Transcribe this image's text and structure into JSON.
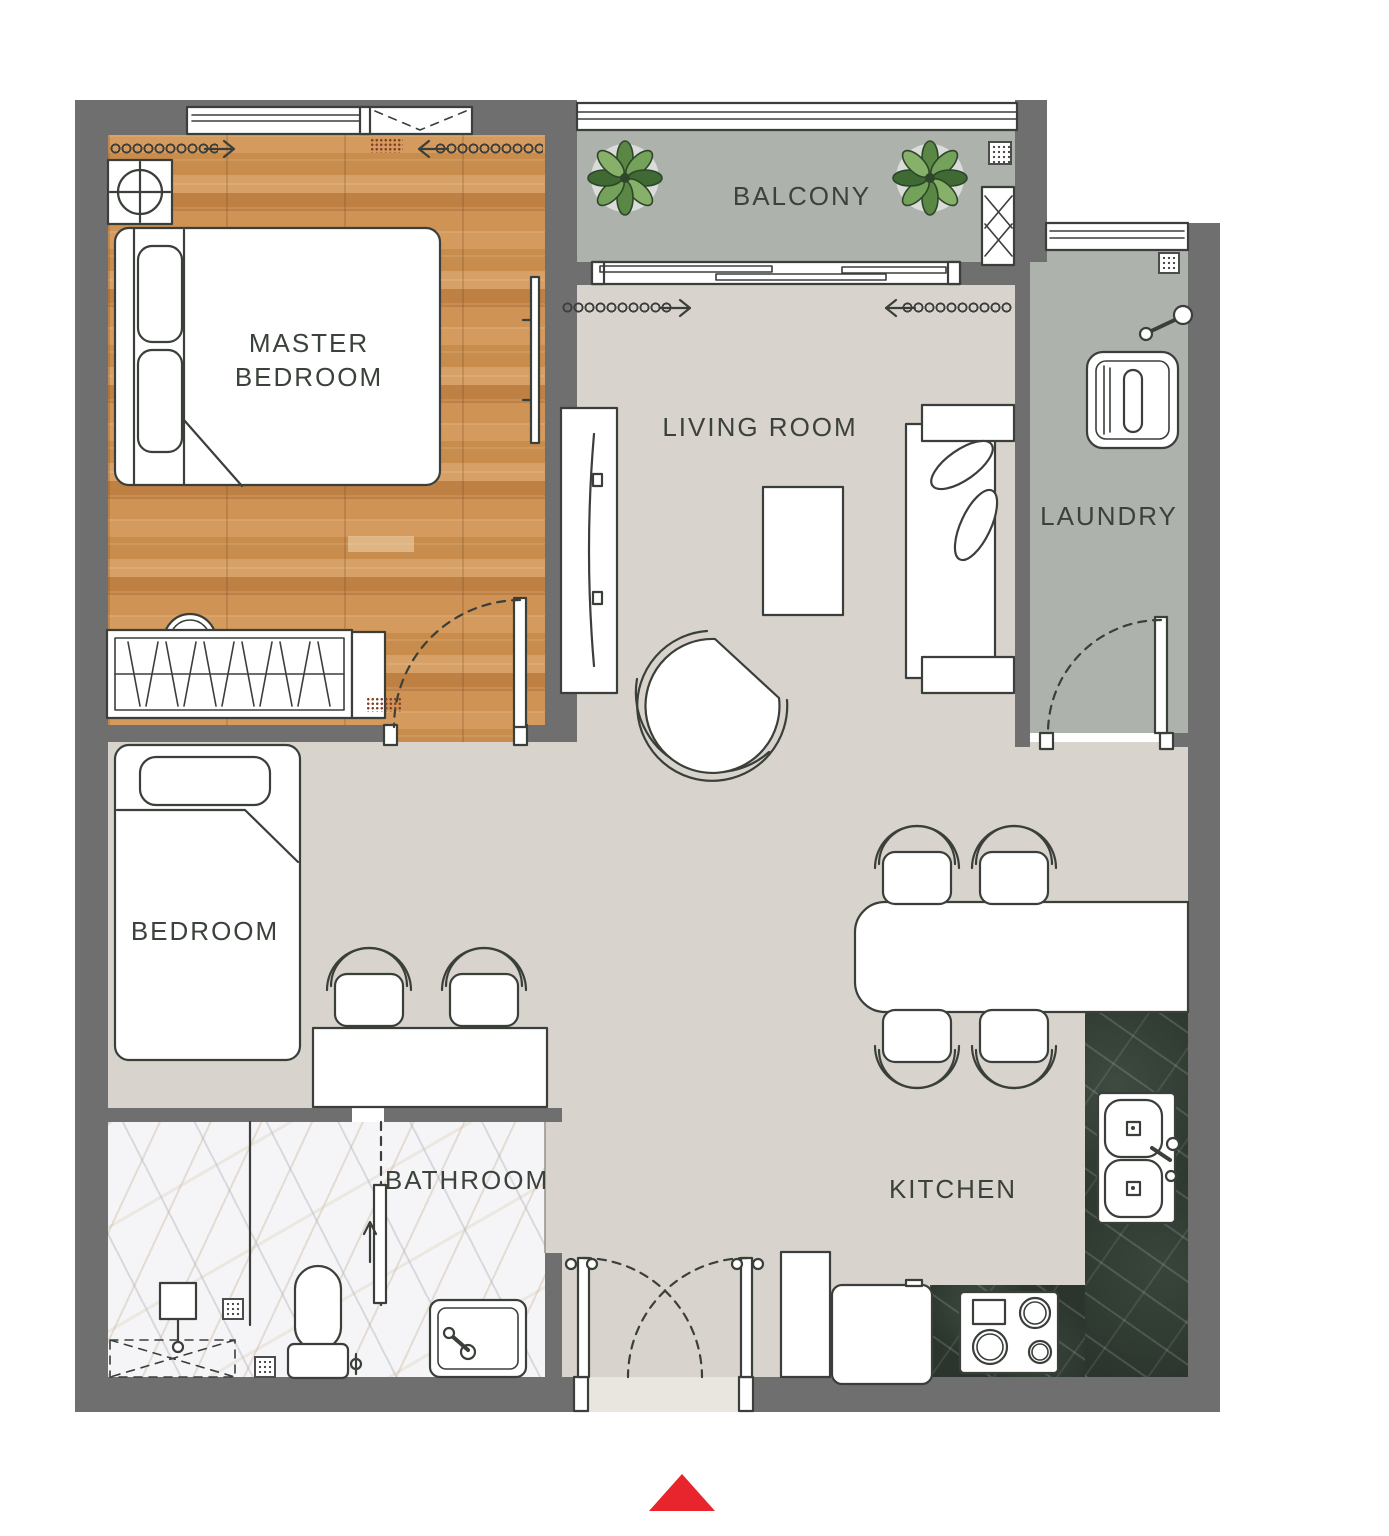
{
  "floorplan": {
    "type": "apartment-floor-plan",
    "rooms": [
      {
        "id": "master-bedroom",
        "label": "MASTER\nBEDROOM"
      },
      {
        "id": "balcony",
        "label": "BALCONY"
      },
      {
        "id": "living-room",
        "label": "LIVING ROOM"
      },
      {
        "id": "laundry",
        "label": "LAUNDRY"
      },
      {
        "id": "bedroom",
        "label": "BEDROOM"
      },
      {
        "id": "bathroom",
        "label": "BATHROOM"
      },
      {
        "id": "kitchen",
        "label": "KITCHEN"
      }
    ],
    "colors": {
      "wall": "#6f6f6f",
      "floor_main": "#d8d3cc",
      "floor_wood": "#cd9355",
      "floor_balcony_laundry": "#adb2ad",
      "floor_bathroom": "#f5f5f7",
      "kitchen_counter": "#2b352d",
      "label_text": "#3b423b",
      "linework": "#3a3f3a",
      "entrance_marker": "#e8252c"
    },
    "entrance": {
      "marker": "red-triangle-arrow",
      "color": "#e8252c"
    },
    "icons": [
      "ceiling-light-icon",
      "double-bed-icon",
      "wardrobe-icon",
      "tv-icon",
      "curtain-icon",
      "window-icon",
      "plant-icon",
      "drain-icon",
      "sliding-door-icon",
      "ac-unit-icon",
      "washing-machine-icon",
      "faucet-icon",
      "door-swing-icon",
      "tv-console-icon",
      "coffee-table-icon",
      "armchair-icon",
      "sofa-icon",
      "single-bed-icon",
      "desk-icon",
      "chair-icon",
      "dining-table-icon",
      "kitchen-sink-icon",
      "stove-icon",
      "fridge-icon",
      "cabinet-icon",
      "shower-icon",
      "toilet-icon",
      "bath-mat-icon",
      "vanity-sink-icon",
      "entrance-arrow-icon"
    ]
  }
}
